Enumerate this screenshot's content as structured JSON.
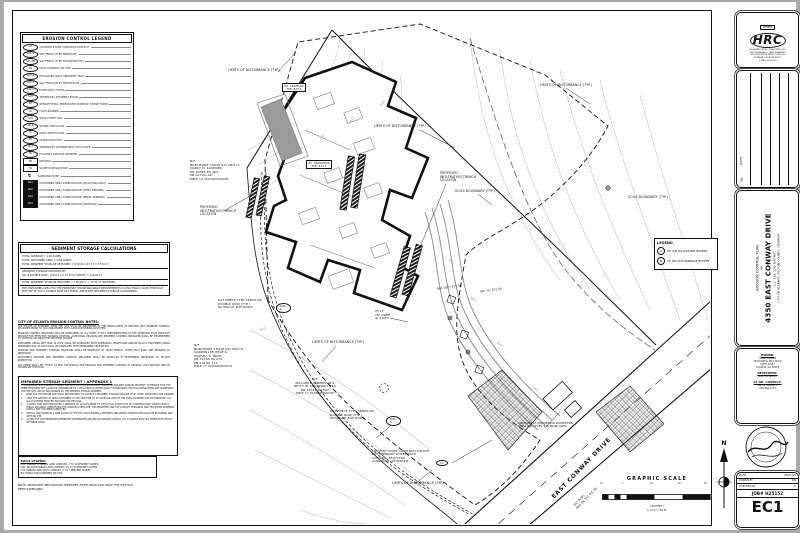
{
  "erosion_legend": {
    "title": "EROSION CONTROL LEGEND",
    "items": [
      {
        "sym": "Co",
        "type": "oval",
        "label": "CRUSHED STONE CONSTRUCTION EXIT"
      },
      {
        "sym": "Sd1-S",
        "type": "oval",
        "label": "SILT FENCE (TYPE SENSITIVE)"
      },
      {
        "sym": "Sd1-NS",
        "type": "oval",
        "label": "SILT FENCE (TYPE NON-SENSITIVE)"
      },
      {
        "sym": "Du",
        "type": "oval",
        "label": "DUST CONTROL ON SITE"
      },
      {
        "sym": "Sd2-P",
        "type": "oval",
        "label": "EXCAVATED INLET SEDIMENT TRAP"
      },
      {
        "sym": "Sd2-F",
        "type": "oval",
        "label": "SILT FENCE INLET PROTECTION"
      },
      {
        "sym": "Sd2-C",
        "type": "oval",
        "label": "CURB INLET FILTER"
      },
      {
        "sym": "Sd3",
        "type": "oval",
        "label": "TEMPORARY SEDIMENT BASIN"
      },
      {
        "sym": "Rt",
        "type": "oval",
        "label": "RETROFITTING, PERFORATED RISER W/ STONE FILTER"
      },
      {
        "sym": "Fb",
        "type": "oval",
        "label": "FLOW BARRIER"
      },
      {
        "sym": "Sd4",
        "type": "oval",
        "label": "ROCK FILTER DAM"
      },
      {
        "sym": "Ch-S",
        "type": "oval",
        "label": "STONE CHECK DAM"
      },
      {
        "sym": "Ip",
        "type": "oval",
        "label": "INLET PROTECTION"
      },
      {
        "sym": "Dv",
        "type": "oval",
        "label": "DIVERSION DITCH"
      },
      {
        "sym": "Ch-T",
        "type": "oval",
        "label": "TEMPORARY CHANNELIZED STRUCTURE"
      },
      {
        "sym": "Sk",
        "type": "oval",
        "label": "FLOATING SURFACE SKIMMER"
      },
      {
        "sym": "Mt",
        "type": "box",
        "label": "MATTING"
      },
      {
        "sym": "Tb",
        "type": "box",
        "label": "SLOPE STABILIZATION"
      },
      {
        "sym": "↯",
        "type": "bolt",
        "label": "SAMPLING POINT"
      },
      {
        "sym": "Ds1",
        "type": "blackbox",
        "label": "DISTURBED AREA STABILIZATION (MULCHING ONLY)"
      },
      {
        "sym": "Ds2",
        "type": "blackbox",
        "label": "DISTURBED AREA STABILIZATION (TEMP. SEEDING)"
      },
      {
        "sym": "Ds3",
        "type": "blackbox",
        "label": "DISTURBED AREA STABILIZATION (PERM. SEEDING)"
      },
      {
        "sym": "Ds4",
        "type": "blackbox",
        "label": "DISTURBED AREA STABILIZATION (SODDING)"
      }
    ]
  },
  "sediment_calcs": {
    "title": "SEDIMENT STORAGE CALCULATIONS",
    "lines": [
      {
        "t": "TOTAL ACREAGE = 1.06 ACRES"
      },
      {
        "t": "TOTAL DISTURBED AREA = 0.56 ACRES"
      },
      {
        "t": "TOTAL SEDIMENT STORAGE REQUIRED = 0.56 AC x 67 CY = 37.52 CY"
      },
      {
        "t": "SEDIMENT STORAGE PROVIDED BY:",
        "cls": "rule"
      },
      {
        "t": "Sd1-S DOUBLE ROW - (533 LF x 0.37 CY/LF WIDTH) = 116.09 CY"
      },
      {
        "t": "TOTAL SEDIMENT STORAGE PROVIDED = 116.09 CY > 37.52 CY REQUIRED",
        "cls": "rule"
      },
      {
        "t": "THE DISTURBED AREA FOR THE PROPOSED STORM DRAINAGE IMPROVEMENTS IS LESS THAN 1 ACRE. THROUGH THE USE OF Sd1-S DOUBLE ROW SILT FENCE, ADEQUATE SEDIMENT STORAGE IS PROVIDED.",
        "cls": "rule"
      }
    ]
  },
  "atlanta_notes": {
    "title": "CITY OF ATLANTA EROSION CONTROL NOTES:",
    "paragraphs": [
      "THE ESCAPE OF SEDIMENT FROM THE SITE SHALL BE PREVENTED BY THE INSTALLATION OF EROSION AND SEDIMENT CONTROL MEASURES PRIOR TO, OR CONCURRENT WITH, LAND-DISTURBING ACTIVITIES.",
      "EROSION CONTROL MEASURES WILL BE MAINTAINED AT ALL TIMES. IF FULL IMPLEMENTATION OF THE APPROVED PLAN DOES NOT PROVIDE FOR EFFECTIVE EROSION CONTROL, ADDITIONAL EROSION AND SEDIMENT CONTROL MEASURES SHALL BE IMPLEMENTED TO CONTROL OR TREAT THE SEDIMENT SOURCE.",
      "DISTURBED AREAS LEFT IDLE 14 DAYS SHALL BE STABILIZED WITH TEMPORARY VEGETATION AND/OR MULCH. DISTURBED AREAS REMAINING IDLE 30 DAYS SHALL BE STABILIZED WITH PERMANENT VEGETATION.",
      "EROSION AND SEDIMENT CONTROL MEASURES SHALL BE INSPECTED AT LEAST WEEKLY, AFTER EACH RAIN, AND REPAIRED AS NECESSARY.",
      "ADDITIONAL EROSION AND SEDIMENT CONTROL MEASURES SHALL BE INSTALLED IF DETERMINED NECESSARY BY ON-SITE INSPECTION.",
      "SILT FENCE SHALL BE 'TYPE-S' AS PER THE MANUAL FOR EROSION AND SEDIMENT CONTROL IN GEORGIA, 2016 EDITION, AND AS SHOWN ON THIS PLAN."
    ]
  },
  "impaired": {
    "title": "IMPAIRED STREAM SEGMENT / APPENDIX 1",
    "intro": "THE PROPOSED SITE DRAINS TO NANCY CREEK WHICH HAS BEEN IDENTIFIED AS AN IMPAIRED STREAM SEGMENT. TO ENSURE THAT THE PERMITTEE DOES NOT CAUSE OR CONTRIBUTE TO A VIOLATION OF WATER QUALITY STANDARDS, THE FOLLOWING ITEMS ARE ADDRESSED FOR THE SITE, WHICH DISCHARGES TO THE IMPAIRED STREAM SEGMENT:",
    "items": [
      {
        "n": "1.",
        "t": "BMPs FOR THE ENTIRE SITE SHALL BE DESIGNED TO ACHIEVE A SEDIMENT STORAGE VOLUME OF 67 CUBIC YARDS PER ACRE DRAINED."
      },
      {
        "n": "2.",
        "t": "LIMIT THE AMOUNT OF AREA DISTURBED AT ANY ONE TIME TO 25 ACRES OR LESS OF THE TOTAL PLANNED SITE DISTURBANCE. ALL CALCULATIONS MUST BE INCLUDED ON THE PLAN."
      },
      {
        "n": "3.",
        "t": "A LARGE SIGN MUST BE POSTED A MINIMUM OF 14 DAYS PRIOR TO THE ACTUAL START DATE OF CONSTRUCTION, VISIBLE FROM A PUBLIC ROADWAY, IDENTIFYING THE CONSTRUCTION SITE, THE PERMITTEE AND THE CONTACT PERSON(S) AND TELEPHONE NUMBERS UNTIL A NOT HAS BEEN SUBMITTED."
      },
      {
        "n": "4.",
        "t": "INSTALL AND MAINTAIN A RAIN GAUGE AT THE SITE. DAILY RAINFALL AMOUNTS AND WEEKLY INSPECTIONS SHALL BE RECORDED AND KEPT ON SITE."
      },
      {
        "n": "5.",
        "t": "ALONG THE SITE PERIMETER WHEREVER STORMWATER MAY BE DISCHARGED, INSTALL Sd1-S DOUBLE ROW SILT FENCE WITH MULCH BETWEEN ROWS."
      }
    ]
  },
  "soils": {
    "title": "SOILS LEGEND:",
    "lines": [
      "GuC: GWINNETT-URBAN LAND COMPLEX, 2 TO 10 PERCENT SLOPES",
      "PuD: PACOLET-URBAN LAND COMPLEX, 10 TO 25 PERCENT SLOPES",
      "UcB: URBAN LAND-CECIL COMPLEX, 2 TO 7 PERCENT SLOPES",
      "NO HYDRIC SOILS PRESENT ON SITE"
    ]
  },
  "gen_note": "NOTE: PROPOSED INFILTRATION TRENCHES TO BE INSTALLED ONCE THE SITE HAS BEEN STABILIZED.",
  "buffer_legend": {
    "title": "LEGEND",
    "items": [
      {
        "sym": "A",
        "label": "25' S/B NO DISTURB BUFFER"
      },
      {
        "sym": "B",
        "label": "75' NO DISTURBANCE BUFFER"
      }
    ]
  },
  "graphic_scale": {
    "title": "GRAPHIC SCALE",
    "ticks": [
      {
        "t": "30",
        "style": {
          "left": "0px"
        }
      },
      {
        "t": "0",
        "style": {
          "left": "22px"
        }
      },
      {
        "t": "30",
        "style": {
          "left": "50px"
        }
      },
      {
        "t": "60",
        "style": {
          "left": "78px"
        }
      },
      {
        "t": "90",
        "style": {
          "left": "104px"
        }
      }
    ],
    "cap1": "( IN FEET )",
    "cap2": "1 inch = 30 ft."
  },
  "north_label": "N",
  "plan_labels": [
    {
      "name": "lod-label",
      "t": "LIMITS OF DISTURBANCE (TYP.)",
      "style": {
        "left": "228px",
        "top": "69px"
      }
    },
    {
      "name": "lod-label",
      "t": "LIMITS OF DISTURBANCE (TYP.)",
      "style": {
        "left": "540px",
        "top": "84px"
      }
    },
    {
      "name": "lod-label",
      "t": "LIMITS OF DISTURBANCE (TYP.)",
      "style": {
        "left": "374px",
        "top": "125px"
      }
    },
    {
      "name": "lod-label",
      "t": "LIMITS OF DISTURBANCE (TYP.)",
      "style": {
        "left": "312px",
        "top": "341px"
      }
    },
    {
      "name": "lod-label",
      "t": "LIMITS OF DISTURBANCE (TYP.)",
      "style": {
        "left": "392px",
        "top": "482px"
      }
    },
    {
      "name": "soils-boundary-label",
      "t": "SOILS BOUNDARY (TYP.)",
      "style": {
        "left": "455px",
        "top": "190px"
      }
    },
    {
      "name": "soils-boundary-label",
      "t": "SOILS BOUNDARY (TYP.)",
      "style": {
        "left": "628px",
        "top": "196px"
      }
    },
    {
      "name": "infiltration-trench-label",
      "t": "PROPOSED\nINFILTRATION TRENCH\nLOCATION",
      "style": {
        "left": "200px",
        "top": "206px",
        "fontSize": "3.1px"
      }
    },
    {
      "name": "infiltration-trench-label",
      "t": "PROPOSED\nINFILTRATION TRENCH\nLOCATION",
      "style": {
        "left": "440px",
        "top": "172px",
        "fontSize": "3.1px"
      }
    },
    {
      "name": "parcel-owner-note",
      "t": "N/F\nNORTHSIDE CHASE S/D UNIT IV\nMARCY M. KUSHNER\nDB 60595 PG 459\nPB 127 PG 46\nPID# 17 0101005S0228",
      "style": {
        "left": "190px",
        "top": "160px",
        "fontSize": "3px"
      }
    },
    {
      "name": "parcel-owner-note",
      "t": "N/F\nNORTHSIDE CHASE S/D UNIT III\nDARWIN LEE HEGE &\nMARSHA S. HEGE\nDB 31786 PG 274\nPB 119 PG 113\nPID# 17 0109000S0012",
      "style": {
        "left": "194px",
        "top": "344px",
        "fontSize": "3px"
      }
    },
    {
      "name": "parcel-owner-note",
      "t": "N/F\nWILLIAM F. ANDERSON &\nBETTY W. ANDERSON JTRS\nDB 44741 PG 597\nPID# 17 0108000S0195",
      "style": {
        "left": "294px",
        "top": "378px",
        "fontSize": "3px",
        "textAlign": "center"
      }
    },
    {
      "name": "silt-fence-label",
      "t": "SILT FENCE TYPE SENSITIVE\nDOUBLE ROW (TYP.)\nW/ MULCH B/W ROWS",
      "style": {
        "left": "218px",
        "top": "299px",
        "fontSize": "3px"
      }
    },
    {
      "name": "silt-fence-label",
      "t": "SILT FENCE TYPE SENSITIVE\nDOUBLE ROW (TYP.)\nW/ MULCH B/W ROWS",
      "style": {
        "left": "330px",
        "top": "410px",
        "fontSize": "3px"
      }
    },
    {
      "name": "pipe-label",
      "t": "25 LF\n18\" HDPE\n@ 4.00%",
      "style": {
        "left": "375px",
        "top": "310px",
        "fontSize": "3px"
      }
    },
    {
      "name": "invert-label",
      "t": "INV. OUT: 872.00",
      "style": {
        "left": "437px",
        "top": "286px",
        "fontSize": "2.8px",
        "transform": "rotate(-8deg)"
      }
    },
    {
      "name": "invert-label",
      "t": "INV. IN: 872.00",
      "style": {
        "left": "480px",
        "top": "289px",
        "fontSize": "2.8px",
        "transform": "rotate(-8deg)"
      }
    },
    {
      "name": "construction-exit-label",
      "t": "CRUSHED STONE CONSTRUCTION EXIT\nW/ TEMPORARY WHEEL WASH\nLATITUDE:   33.87376N\nLONGITUDE: 84.40833W",
      "style": {
        "left": "372px",
        "top": "450px",
        "fontSize": "2.8px"
      }
    },
    {
      "name": "dumpster-label",
      "t": "CONSTRUCTION DEBRIS DUMPSTER\nAREA AND FUEL STORAGE AREA",
      "style": {
        "left": "518px",
        "top": "422px",
        "fontSize": "2.9px"
      }
    },
    {
      "name": "road-name-label",
      "t": "EAST CONWAY DRIVE",
      "style": {
        "left": "556px",
        "top": "494px",
        "fontSize": "5.8px",
        "fontWeight": "bold",
        "letterSpacing": "0.8px",
        "transform": "rotate(-46deg)",
        "transformOrigin": "left bottom"
      }
    },
    {
      "name": "road-rw-label",
      "t": "(40' R/W)\nPER PB 341 PG 76",
      "style": {
        "left": "578px",
        "top": "503px",
        "fontSize": "3px",
        "transform": "rotate(-46deg)",
        "transformOrigin": "left bottom"
      }
    },
    {
      "name": "building-label",
      "t": "PR. ADDITION\nFFE: 873.5",
      "cls": "boxed",
      "style": {
        "left": "282px",
        "top": "83px",
        "fontSize": "2.6px"
      }
    },
    {
      "name": "building-label",
      "t": "EX. RESIDENCE\nFFE: 873.5",
      "cls": "boxed",
      "style": {
        "left": "306px",
        "top": "160px",
        "fontSize": "2.6px"
      }
    },
    {
      "name": "contour-elevation",
      "t": "880",
      "style": {
        "left": "298px",
        "top": "148px",
        "fontSize": "3px",
        "color": "#999",
        "transform": "rotate(-55deg)"
      }
    },
    {
      "name": "contour-elevation",
      "t": "876",
      "style": {
        "left": "320px",
        "top": "136px",
        "fontSize": "3px",
        "color": "#999",
        "transform": "rotate(-55deg)"
      }
    },
    {
      "name": "contour-elevation",
      "t": "872",
      "style": {
        "left": "350px",
        "top": "118px",
        "fontSize": "3px",
        "color": "#999",
        "transform": "rotate(-55deg)"
      }
    },
    {
      "name": "contour-elevation",
      "t": "868",
      "style": {
        "left": "380px",
        "top": "102px",
        "fontSize": "3px",
        "color": "#999",
        "transform": "rotate(-55deg)"
      }
    },
    {
      "name": "contour-elevation",
      "t": "872",
      "style": {
        "left": "448px",
        "top": "260px",
        "fontSize": "3px",
        "color": "#999",
        "transform": "rotate(35deg)"
      }
    },
    {
      "name": "contour-elevation",
      "t": "868",
      "style": {
        "left": "470px",
        "top": "298px",
        "fontSize": "3px",
        "color": "#999",
        "transform": "rotate(35deg)"
      }
    },
    {
      "name": "contour-elevation",
      "t": "864",
      "style": {
        "left": "496px",
        "top": "343px",
        "fontSize": "3px",
        "color": "#999",
        "transform": "rotate(35deg)"
      }
    },
    {
      "name": "contour-elevation",
      "t": "860",
      "style": {
        "left": "532px",
        "top": "388px",
        "fontSize": "3px",
        "color": "#999",
        "transform": "rotate(35deg)"
      }
    },
    {
      "name": "contour-elevation",
      "t": "876",
      "style": {
        "left": "260px",
        "top": "328px",
        "fontSize": "3px",
        "color": "#999",
        "transform": "rotate(-20deg)"
      }
    },
    {
      "name": "contour-elevation",
      "t": "872",
      "style": {
        "left": "298px",
        "top": "358px",
        "fontSize": "3px",
        "color": "#999",
        "transform": "rotate(-30deg)"
      }
    }
  ],
  "callouts": [
    {
      "t": "Sd1-S",
      "style": {
        "left": "276px",
        "top": "303px"
      }
    },
    {
      "t": "Sd1-S",
      "style": {
        "left": "386px",
        "top": "416px"
      }
    },
    {
      "t": "Co",
      "style": {
        "left": "436px",
        "top": "460px"
      }
    }
  ],
  "titleblock": {
    "firm": {
      "member": "MEMBER",
      "logo": "HRC",
      "lines": [
        "HIGHLAND RIDGE CONSULTING, INC.",
        "CIVIL ENGINEERS - LAND PLANNERS",
        "1100 NORTHSIDE DRIVE, SUITE 200",
        "ATLANTA, GEORGIA 30318",
        "T: (404) 355-1000"
      ]
    },
    "revision": {
      "col_no": "No.",
      "col_date": "DATE",
      "col_rev": "REVISION"
    },
    "project": {
      "line1": "EROSION CONTROL PLAN",
      "line2": "OF",
      "title": "4350 EAST CONWAY DRIVE",
      "line3": "L.L. 138, 17th DISTRICT",
      "line4": "CITY OF ATLANTA, FULTON COUNTY, GEORGIA"
    },
    "owner": {
      "heading": "OWNER:",
      "lines": [
        "AVERY DESIGN",
        "320 HOWELL MILL ROAD",
        "SUITE D-567",
        "ATLANTA, GA 30318"
      ]
    },
    "developer": {
      "heading": "DEVELOPER:",
      "lines": [
        "SAME AS ABOVE"
      ]
    },
    "contact": {
      "heading": "24 HR. CONTACT:",
      "lines": [
        "WILLIE FARVER, II",
        "678-296-1179"
      ]
    },
    "job": {
      "rows": [
        {
          "label": "DATE",
          "value": "08/11/25"
        },
        {
          "label": "DRAWN BY",
          "value": "KW"
        },
        {
          "label": "CHECKED BY",
          "value": "JT"
        }
      ],
      "job_line": "JOB#  H25152",
      "sheet": "EC1"
    }
  }
}
